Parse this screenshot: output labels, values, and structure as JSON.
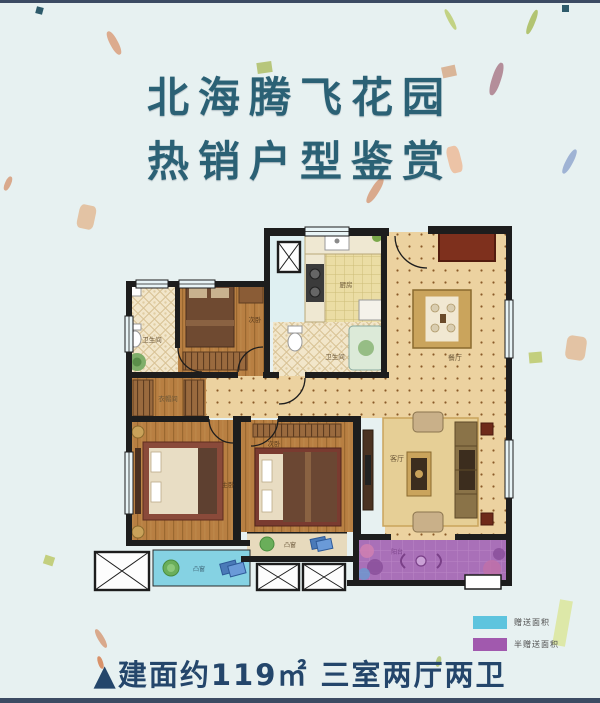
{
  "page": {
    "title_line1": "北海腾飞花园",
    "title_line2": "热销户型鉴赏",
    "caption": "▲建面约119㎡ 三室两厅两卫"
  },
  "floorplan": {
    "rooms": {
      "bath1": "卫生间",
      "bed2": "次卧",
      "kitchen": "厨房",
      "bath2": "卫生间",
      "dining": "餐厅",
      "cloak": "衣帽间",
      "master": "主卧",
      "bed3": "次卧",
      "living": "客厅",
      "balcony": "阳台",
      "bay1": "凸窗",
      "bay2": "凸窗"
    }
  },
  "legend": {
    "items": [
      {
        "label": "赠送面积",
        "color": "#5ec4de"
      },
      {
        "label": "半赠送面积",
        "color": "#a159ae"
      }
    ]
  },
  "colors": {
    "background": "#e7f1f1",
    "title": "#2b6175",
    "caption": "#24466b",
    "wall": "#1d1d1d",
    "bay_window": "#85d2e3",
    "balcony": "#a970b8"
  }
}
